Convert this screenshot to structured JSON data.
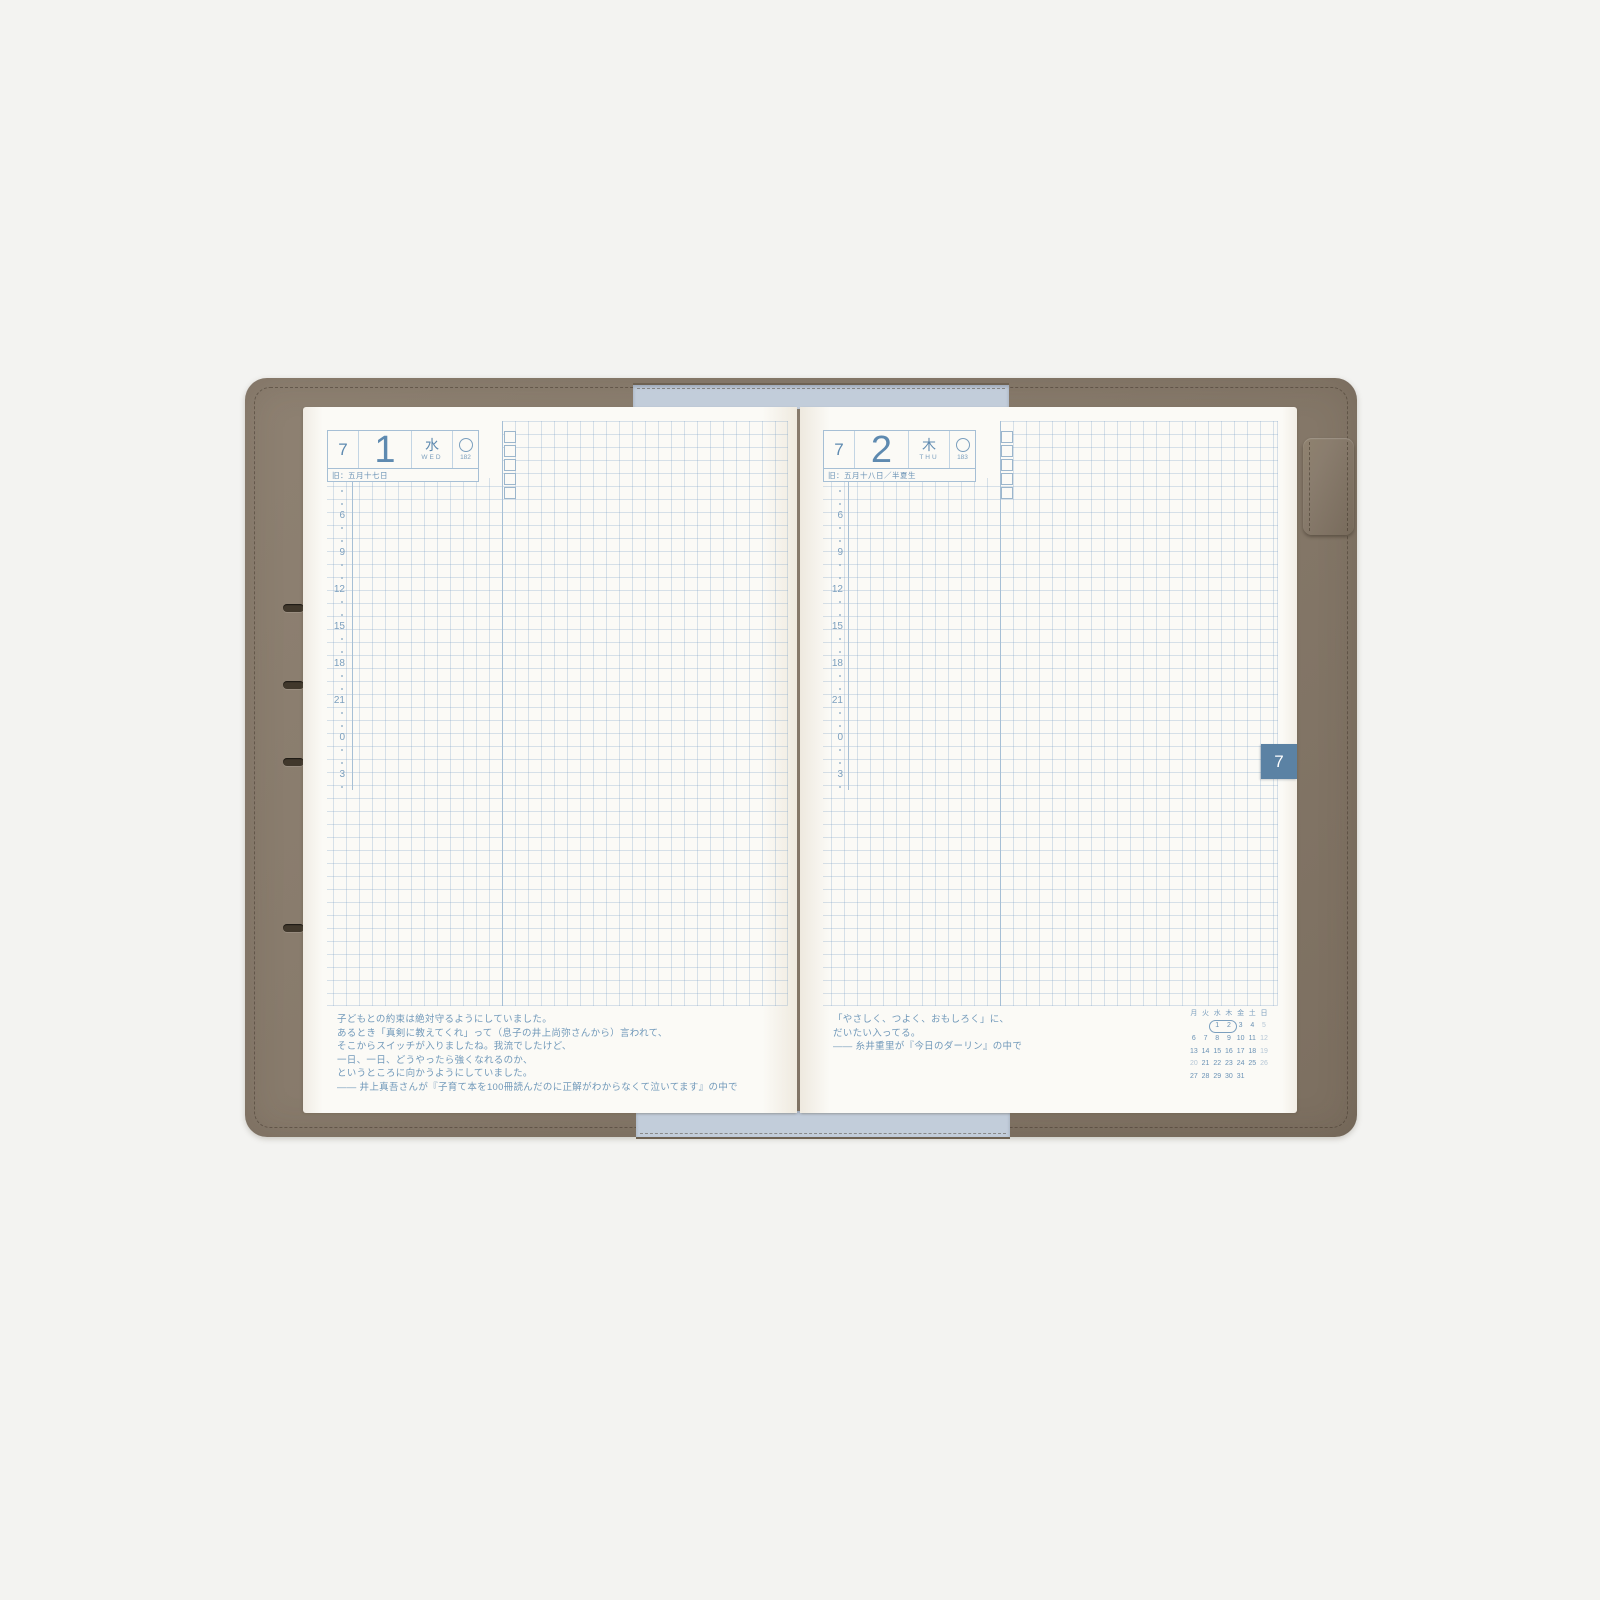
{
  "colors": {
    "background": "#f3f3f1",
    "leather": "#877a6b",
    "lining_blue": "#c2cdda",
    "page": "#fbfaf6",
    "grid_blue": "#c7d5e2",
    "accent_blue": "#6a92b5",
    "tab_blue": "#5b82a4"
  },
  "left_page": {
    "header": {
      "month": "7",
      "day": "1",
      "weekday_jp": "水",
      "weekday_en": "WED",
      "moon_icon": "circle-outline",
      "day_of_year": "182",
      "lunar_date": "旧：五月十七日"
    },
    "timeline_hours": [
      "6",
      "9",
      "12",
      "15",
      "18",
      "21",
      "0",
      "3"
    ],
    "quote_lines": [
      "子どもとの約束は絶対守るようにしていました。",
      "あるとき「真剣に教えてくれ」って（息子の井上尚弥さんから）言われて、",
      "そこからスイッチが入りましたね。我流でしたけど、",
      "一日、一日、どうやったら強くなれるのか、",
      "というところに向かうようにしていました。",
      "―― 井上真吾さんが『子育て本を100冊読んだのに正解がわからなくて泣いてます』の中で"
    ]
  },
  "right_page": {
    "header": {
      "month": "7",
      "day": "2",
      "weekday_jp": "木",
      "weekday_en": "THU",
      "moon_icon": "circle-outline",
      "day_of_year": "183",
      "lunar_date": "旧：五月十八日／半夏生"
    },
    "timeline_hours": [
      "6",
      "9",
      "12",
      "15",
      "18",
      "21",
      "0",
      "3"
    ],
    "quote_lines": [
      "「やさしく、つよく、おもしろく」に、",
      "だいたい入ってる。",
      "―― 糸井重里が『今日のダーリン』の中で"
    ],
    "month_tab": "7",
    "mini_calendar": {
      "day_headers": [
        "月",
        "火",
        "水",
        "木",
        "金",
        "土",
        "日"
      ],
      "weeks": [
        [
          "",
          "",
          "1",
          "2",
          "3",
          "4",
          "5"
        ],
        [
          "6",
          "7",
          "8",
          "9",
          "10",
          "11",
          "12"
        ],
        [
          "13",
          "14",
          "15",
          "16",
          "17",
          "18",
          "19"
        ],
        [
          "20",
          "21",
          "22",
          "23",
          "24",
          "25",
          "26"
        ],
        [
          "27",
          "28",
          "29",
          "30",
          "31",
          "",
          ""
        ]
      ],
      "highlighted_days": [
        "1",
        "2"
      ],
      "muted_days": [
        "5",
        "12",
        "19",
        "20",
        "26"
      ]
    }
  }
}
